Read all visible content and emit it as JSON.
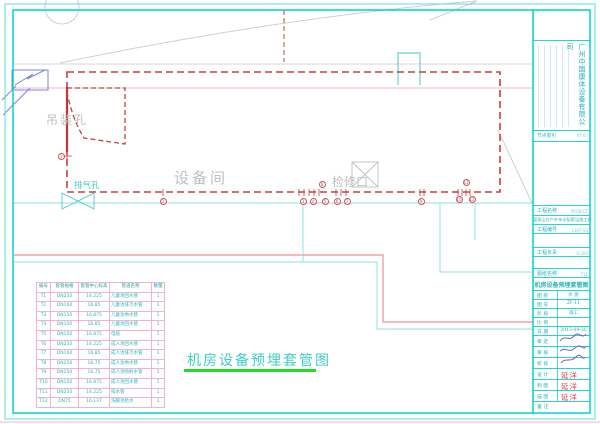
{
  "sheet": {
    "drawing_title": "机房设备预埋套管图",
    "labels": {
      "hoist_hole": "吊装孔",
      "exhaust_hole": "排气孔",
      "equipment_room": "设备间",
      "access_hatch": "检修口"
    }
  },
  "sleeve_table": {
    "headers": [
      "编号",
      "套管规格",
      "套管中心标高",
      "管道名称",
      "数量"
    ],
    "rows": [
      [
        "T1",
        "DN250",
        "16.225",
        "儿童池回水管",
        "1"
      ],
      [
        "T2",
        "DN100",
        "16.85",
        "儿童池排污水管",
        "1"
      ],
      [
        "T3",
        "DN150",
        "16.875",
        "儿童池供水管",
        "1"
      ],
      [
        "T4",
        "DN100",
        "16.85",
        "儿童池回水管",
        "1"
      ],
      [
        "T5",
        "DN150",
        "16.875",
        "电缆",
        "1"
      ],
      [
        "T6",
        "DN250",
        "16.225",
        "成人池回水管",
        "1"
      ],
      [
        "T7",
        "DN100",
        "16.85",
        "成人池排污水管",
        "1"
      ],
      [
        "T8",
        "DN250",
        "16.75",
        "成人池供水管",
        "1"
      ],
      [
        "T9",
        "DN250",
        "16.75",
        "成人池喷射水管",
        "1"
      ],
      [
        "T10",
        "DN150",
        "16.875",
        "成人池回水管",
        "1"
      ],
      [
        "T11",
        "DN250",
        "16.225",
        "排水管",
        "1"
      ],
      [
        "T12",
        "DN75",
        "16.137",
        "洗脚池给水",
        "1"
      ]
    ]
  },
  "balloons": [
    {
      "n": "1",
      "x": 61,
      "y": 156
    },
    {
      "n": "2",
      "x": 163,
      "y": 201
    },
    {
      "n": "3",
      "x": 303,
      "y": 201
    },
    {
      "n": "4",
      "x": 313,
      "y": 201
    },
    {
      "n": "5",
      "x": 325,
      "y": 201
    },
    {
      "n": "6",
      "x": 337,
      "y": 201
    },
    {
      "n": "7",
      "x": 347,
      "y": 201
    },
    {
      "n": "8",
      "x": 322,
      "y": 184
    },
    {
      "n": "9",
      "x": 421,
      "y": 201
    },
    {
      "n": "10",
      "x": 459,
      "y": 199
    },
    {
      "n": "11",
      "x": 466,
      "y": 182
    },
    {
      "n": "12",
      "x": 472,
      "y": 199
    }
  ],
  "title_block": {
    "company": "广州中国康体设备有限公司",
    "index_label": "节点索引",
    "index_value": "KT-03",
    "project_name_label": "工程名称",
    "project_name_tag": "PROJECT",
    "project_name": "温泉山庄户外亲水配套设施工程",
    "project_no_label": "工程编号",
    "project_no_value": "1307-SS",
    "project_lead_label": "工程负责",
    "project_lead_value": "0.200",
    "drawing_name_label": "图纸名称",
    "drawing_name_tag": "T11",
    "drawing_name": "机房设备预埋套管图",
    "meta_rows": [
      {
        "label": "图 别",
        "value": "水 施"
      },
      {
        "label": "图 号",
        "value": "ZF-11"
      },
      {
        "label": "阶 段",
        "value": "施工"
      },
      {
        "label": "比 例",
        "value": ""
      },
      {
        "label": "日 期",
        "value": "2013-09-30"
      }
    ],
    "sign_rows": [
      {
        "label": "审 定",
        "type": "signature",
        "stamp": ""
      },
      {
        "label": "审 核",
        "type": "signature",
        "stamp": ""
      },
      {
        "label": "校 核",
        "type": "signature",
        "stamp": ""
      },
      {
        "label": "设 计",
        "type": "stamp",
        "stamp": "延洋"
      },
      {
        "label": "制 图",
        "type": "stamp",
        "stamp": "延洋"
      },
      {
        "label": "描 图",
        "type": "stamp",
        "stamp": "延洋"
      }
    ],
    "note_label": "备 注"
  },
  "colors": {
    "border_cyan": "#00d2d2",
    "line_cyan": "#8fe0e0",
    "red_dashed": "#c64040",
    "pink_grid": "#efb3d6",
    "salmon_line": "#f09090",
    "green_underline": "#1ee01e",
    "stamp_red": "#e04545",
    "teal_text": "#2ab5b5"
  }
}
